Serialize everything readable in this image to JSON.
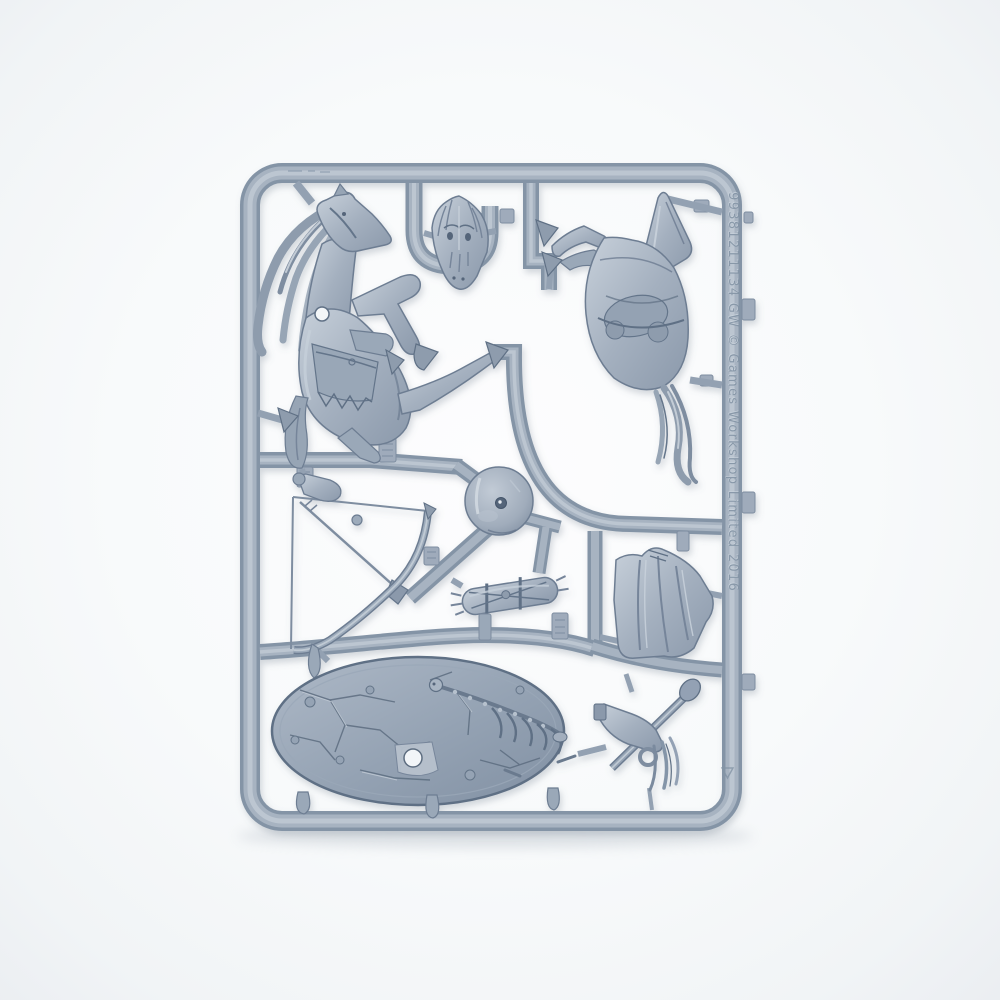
{
  "photo": {
    "subject": "grey plastic model sprue with miniature parts",
    "background": "plain white studio backdrop"
  },
  "sprue": {
    "embossed_text": "99381211134 GW © Games Workshop Limited 2016",
    "colors": {
      "plastic_base": "#a4b0bf",
      "plastic_highlight": "#c9d2dc",
      "plastic_shadow": "#74849a",
      "plastic_deep": "#5f7085",
      "background": "#f6f8fa"
    },
    "parts": [
      {
        "id": "rearing-horse",
        "label": "rearing horse body with flowing mane"
      },
      {
        "id": "leaping-horse",
        "label": "leaping horse body with tail"
      },
      {
        "id": "horse-head",
        "label": "horse head / bestial face"
      },
      {
        "id": "bow",
        "label": "drawn bow with arrow"
      },
      {
        "id": "round-disc",
        "label": "round rock disc with centre hole"
      },
      {
        "id": "bundle",
        "label": "strapped bedroll bundle"
      },
      {
        "id": "cloak",
        "label": "draped cloak"
      },
      {
        "id": "oval-base",
        "label": "oval scenic base with cracked earth and skeleton"
      },
      {
        "id": "totem-arm",
        "label": "arm holding horsehair totem"
      }
    ]
  }
}
